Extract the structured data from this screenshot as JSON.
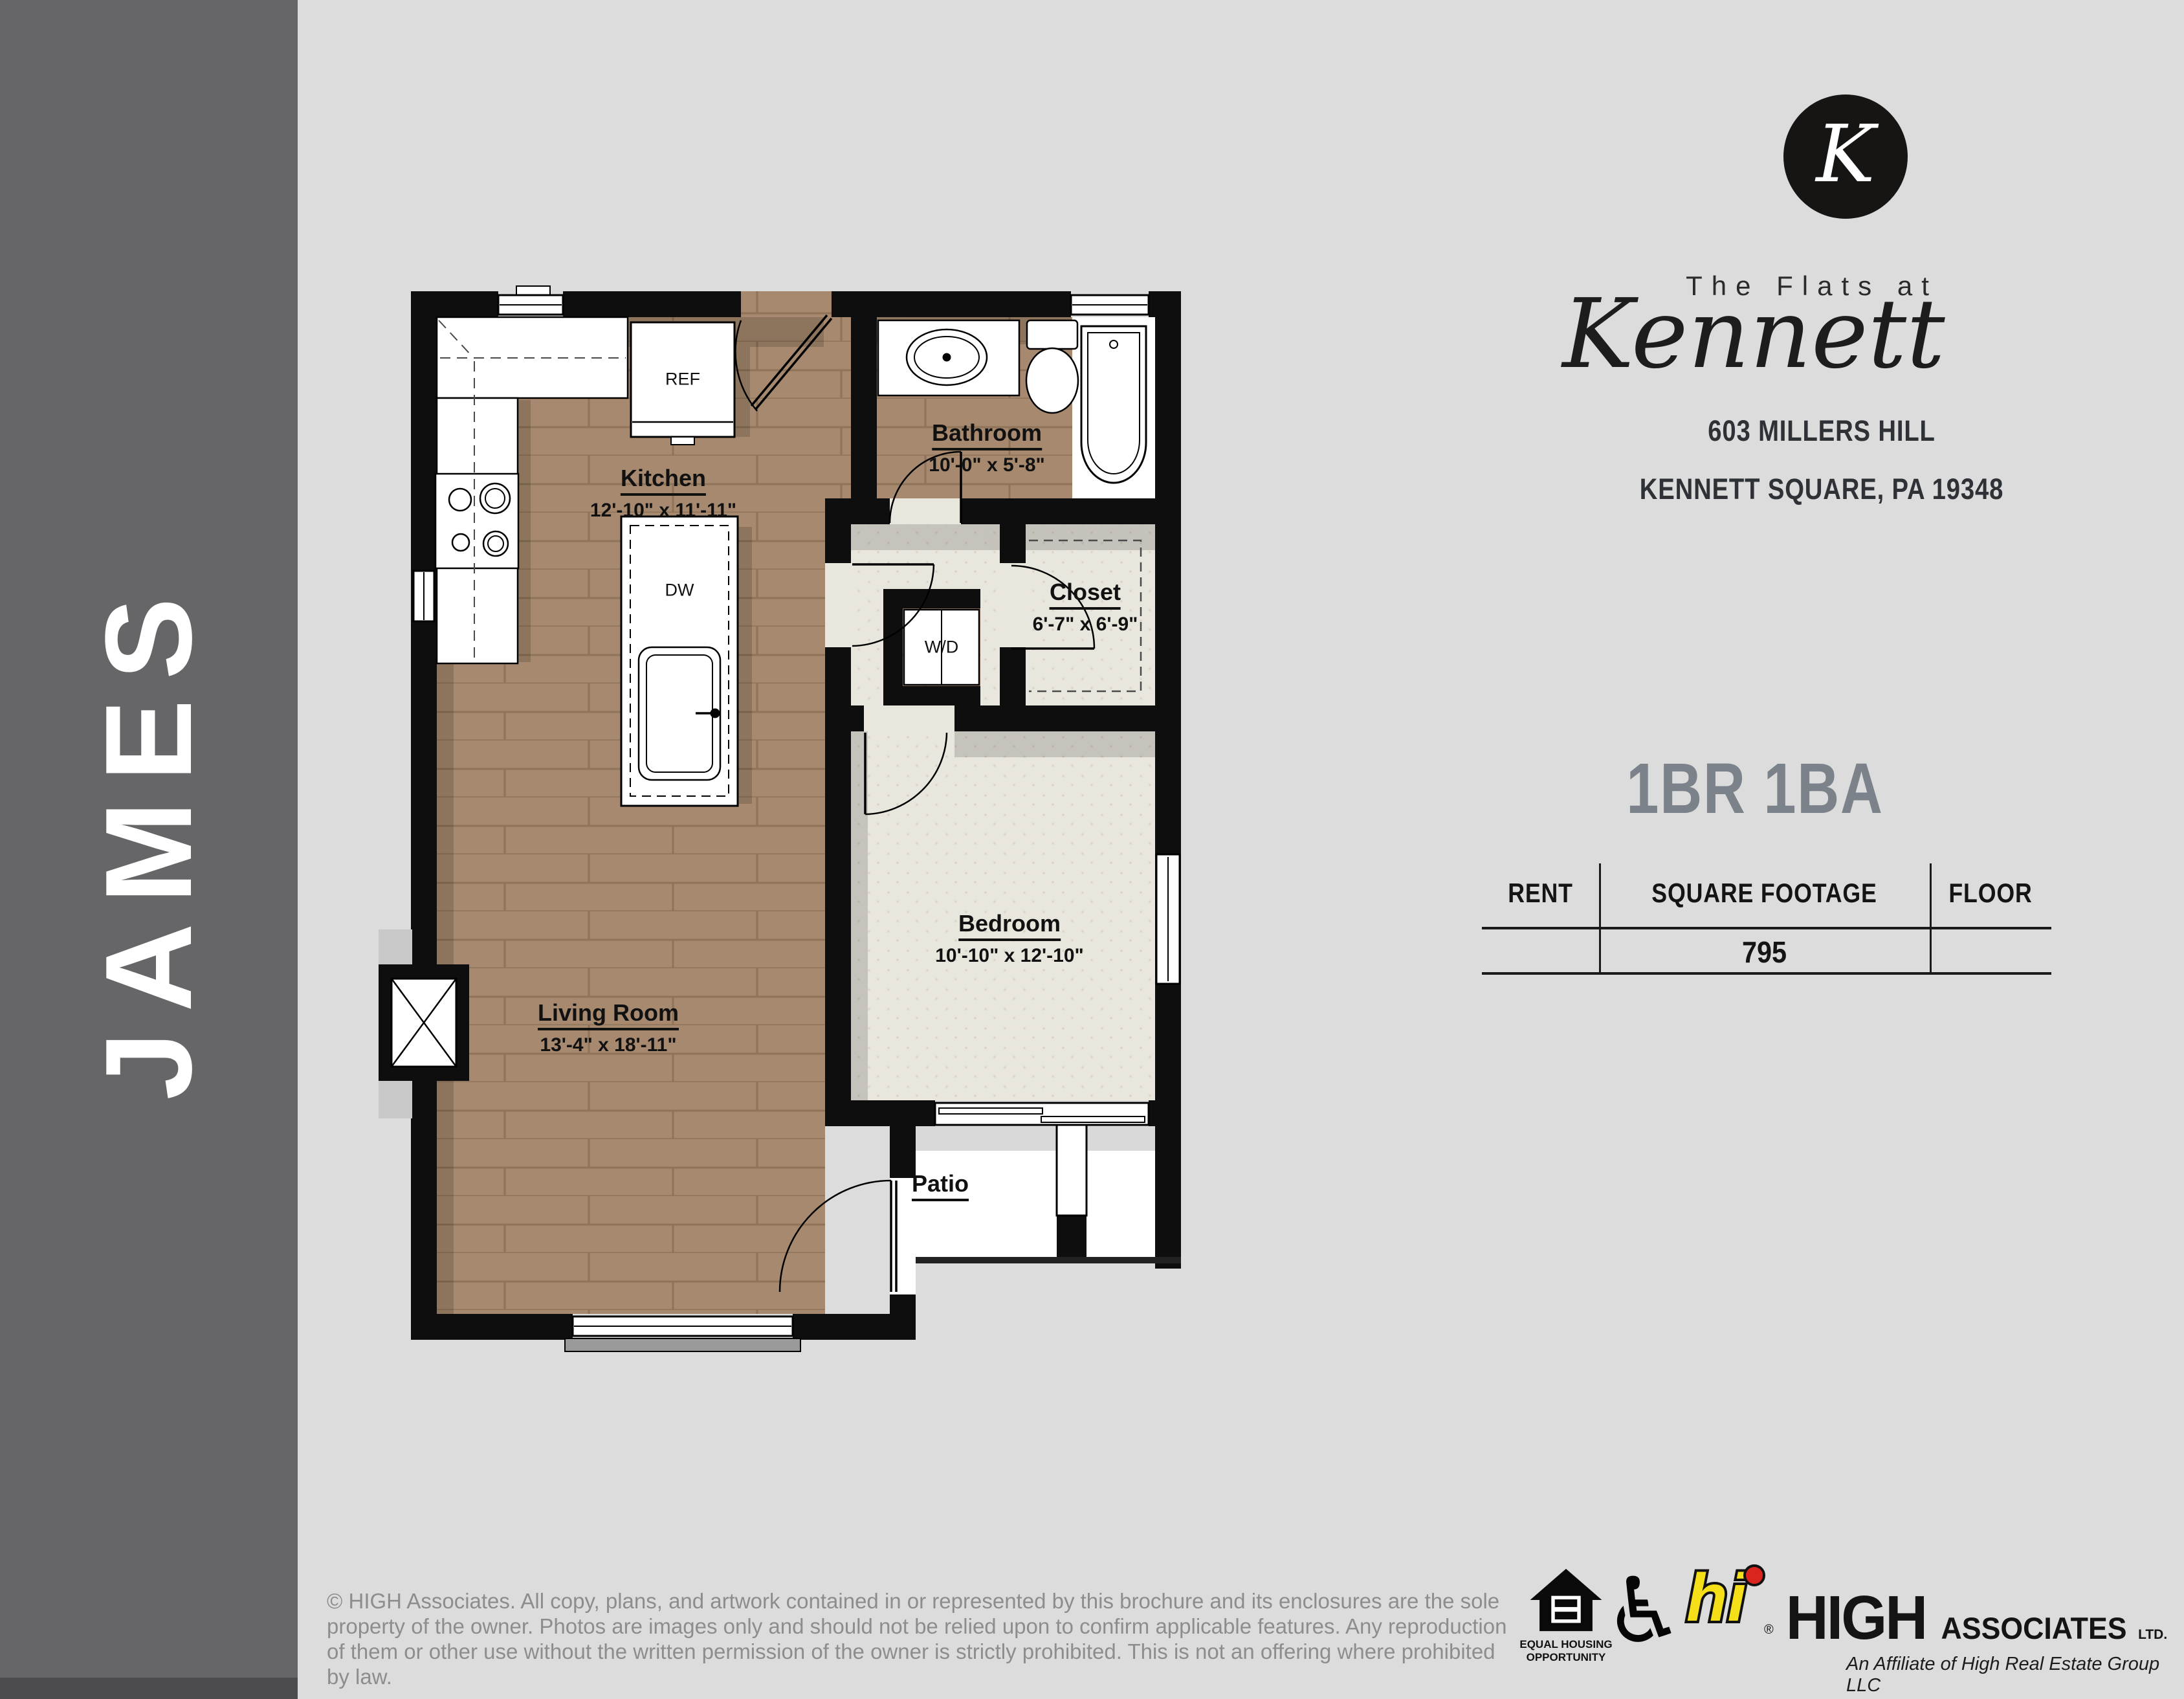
{
  "sidebar": {
    "plan_name": "JAMES"
  },
  "brand": {
    "monogram": "K",
    "line1": "The Flats at",
    "script": "Kennett",
    "address_line1": "603 MILLERS HILL",
    "address_line2": "KENNETT SQUARE, PA 19348"
  },
  "summary": {
    "unit_type": "1BR 1BA",
    "accent_color": "#7b828a",
    "table": {
      "headers": [
        "RENT",
        "SQUARE FOOTAGE",
        "FLOOR"
      ],
      "rent": "",
      "square_footage": "795",
      "floor": ""
    }
  },
  "floorplan": {
    "rooms": {
      "kitchen": {
        "name": "Kitchen",
        "dims": "12'-10\" x 11'-11\""
      },
      "bathroom": {
        "name": "Bathroom",
        "dims": "10'-0\" x 5'-8\""
      },
      "closet": {
        "name": "Closet",
        "dims": "6'-7\" x 6'-9\""
      },
      "bedroom": {
        "name": "Bedroom",
        "dims": "10'-10\" x 12'-10\""
      },
      "living": {
        "name": "Living Room",
        "dims": "13'-4\" x 18'-11\""
      },
      "patio": {
        "name": "Patio"
      }
    },
    "fixtures": {
      "ref": "REF",
      "dw": "DW",
      "wd": "W/D"
    },
    "colors": {
      "wood": "#a6896e",
      "wood_line": "#8f7459",
      "carpet": "#e9e6dd",
      "wall": "#0e0e0e"
    }
  },
  "footer": {
    "copyright": "© HIGH Associates. All copy, plans, and artwork contained in or represented by this brochure and its enclosures are the sole property of the owner. Photos are images only and should not be relied upon to confirm applicable features. Any reproduction of them or other use without the written permission of the owner is strictly prohibited. This is not an offering where prohibited by law.",
    "equal_housing": {
      "line1": "EQUAL HOUSING",
      "line2": "OPPORTUNITY"
    },
    "high": {
      "hi": "hi",
      "reg": "®",
      "name": "HIGH",
      "suffix": "ASSOCIATES",
      "ltd": "LTD.",
      "affiliate": "An Affiliate of High Real Estate Group LLC",
      "yellow": "#f4df18",
      "red": "#d9251d"
    }
  }
}
